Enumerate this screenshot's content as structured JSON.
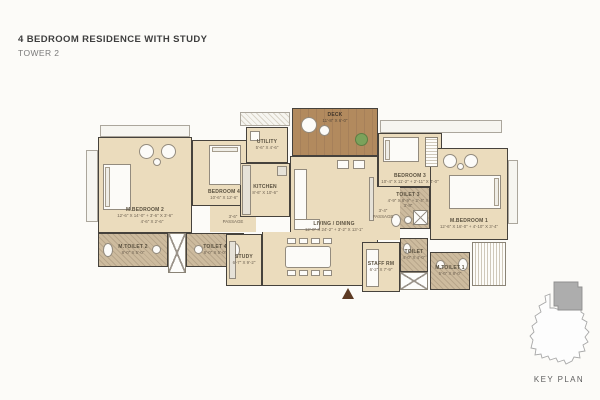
{
  "header": {
    "title": "4 BEDROOM RESIDENCE WITH STUDY",
    "subtitle": "TOWER 2"
  },
  "key_plan": {
    "label": "KEY PLAN"
  },
  "colors": {
    "floor": "#ebdcbd",
    "wall": "#46423c",
    "toilet_floor": "#cdbb9e",
    "deck_wood": "#b28a5e",
    "entry_arrow": "#5d3a23",
    "key_plan_highlight": "#adadad"
  },
  "rooms": {
    "m_bedroom_2": {
      "name": "M.BEDROOM 2",
      "dims": "12'-6\" X 14'-0\" + 3'-6\" X 3'-6\""
    },
    "bedroom_4": {
      "name": "BEDROOM 4",
      "dims": "10'-6\" X 12'-6\""
    },
    "dress_2": {
      "dims": "4'-6\" X 2'-6\""
    },
    "m_toilet_2": {
      "name": "M.TOILET 2",
      "dims": "8'-0\" X 5'-0\""
    },
    "toilet_4": {
      "name": "TOILET 4",
      "dims": "8'-0\" X 5'-0\""
    },
    "passage_2": {
      "name": "3'-6\"",
      "sub": "PASSAGE"
    },
    "utility": {
      "name": "UTILITY",
      "dims": "5'-6\" X 4'-6\""
    },
    "kitchen": {
      "name": "KITCHEN",
      "dims": "8'-6\" X 10'-6\""
    },
    "deck": {
      "name": "DECK",
      "dims": "11'-8\" X 6'-0\""
    },
    "living_dining": {
      "name": "LIVING / DINING",
      "dims": "12'-0\" X 24'-2\" + 3'-2\" X 13'-1\""
    },
    "bedroom_3": {
      "name": "BEDROOM 3",
      "dims": "10'-4\" X 11'-2\" + 2'-11\" X 4'-0\""
    },
    "toilet_3": {
      "name": "TOILET 3",
      "dims": "4'-9\" X 8'-9\" + 2'-4\" X 3'-8\""
    },
    "passage_1": {
      "name": "3'-4\"",
      "sub": "PASSAGE"
    },
    "m_bedroom_1": {
      "name": "M.BEDROOM 1",
      "dims": "12'-6\" X 16'-0\" + 4'-10\" X 3'-4\""
    },
    "staff_rm": {
      "name": "STAFF RM",
      "dims": "6'-2\" X 7'-9\""
    },
    "staff_toilet": {
      "name": "TOILET",
      "dims": "4'-0\" X 4'-0\""
    },
    "m_toilet_1": {
      "name": "M.TOILET 1",
      "dims": "5'-0\" X 8'-0\""
    },
    "study": {
      "name": "STUDY",
      "dims": "6'-7\" X 9'-2\""
    }
  }
}
